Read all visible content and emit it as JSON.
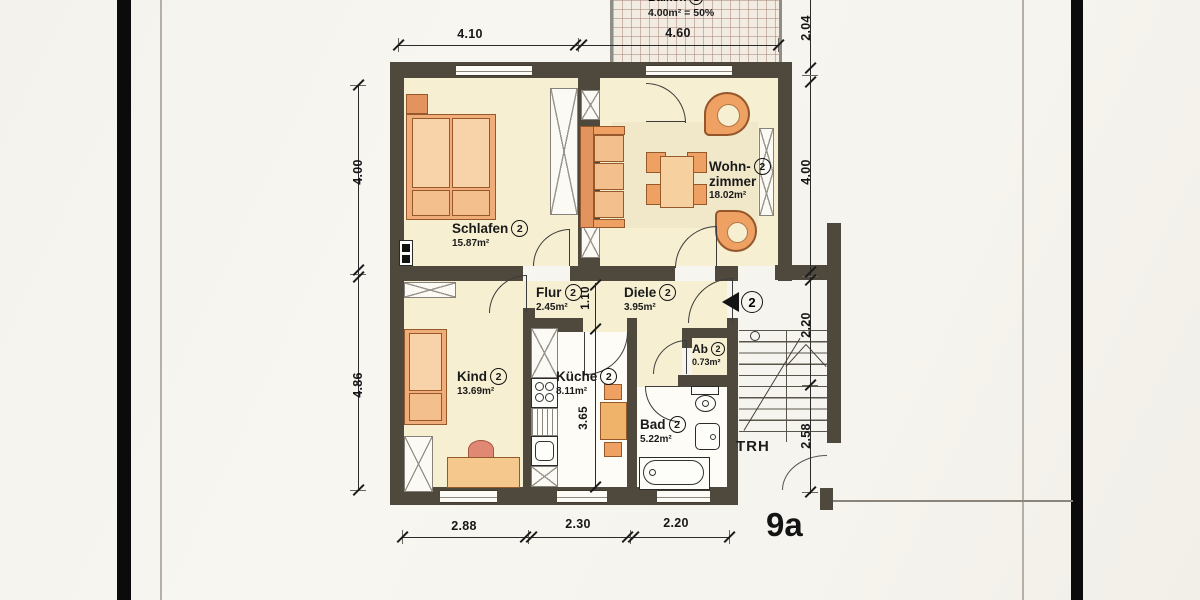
{
  "plan": {
    "house_number": "9a",
    "stairwell_label": "TRH",
    "balcony": {
      "name": "Balkon",
      "unit": "2",
      "area_note": "4.00m² = 50%"
    },
    "entry": {
      "unit": "2"
    },
    "rooms": [
      {
        "name": "Schlafen",
        "unit": "2",
        "area": "15.87m²"
      },
      {
        "name": "Wohn-",
        "name_line2": "zimmer",
        "unit": "2",
        "area": "18.02m²"
      },
      {
        "name": "Flur",
        "unit": "2",
        "area": "2.45m²"
      },
      {
        "name": "Diele",
        "unit": "2",
        "area": "3.95m²"
      },
      {
        "name": "Kind",
        "unit": "2",
        "area": "13.69m²"
      },
      {
        "name": "Küche",
        "unit": "2",
        "area": "8.11m²"
      },
      {
        "name": "Ab",
        "unit": "2",
        "area": "0.73m²"
      },
      {
        "name": "Bad",
        "unit": "2",
        "area": "5.22m²"
      }
    ],
    "dimensions": {
      "top": [
        "4.10",
        "4.60"
      ],
      "right": [
        "2.04",
        "4.00",
        "2.20",
        "2.58"
      ],
      "left": [
        "4.00",
        "4.86"
      ],
      "bottom": [
        "2.88",
        "2.30",
        "2.20"
      ],
      "inner": [
        "1.10",
        "3.65"
      ]
    },
    "colors": {
      "wall": "#4f483c",
      "room_fill": "#f6efd2",
      "wet_room_fill": "#fdfcf6",
      "furniture_orange": "#efa063",
      "paper": "#f7f5f0"
    }
  }
}
